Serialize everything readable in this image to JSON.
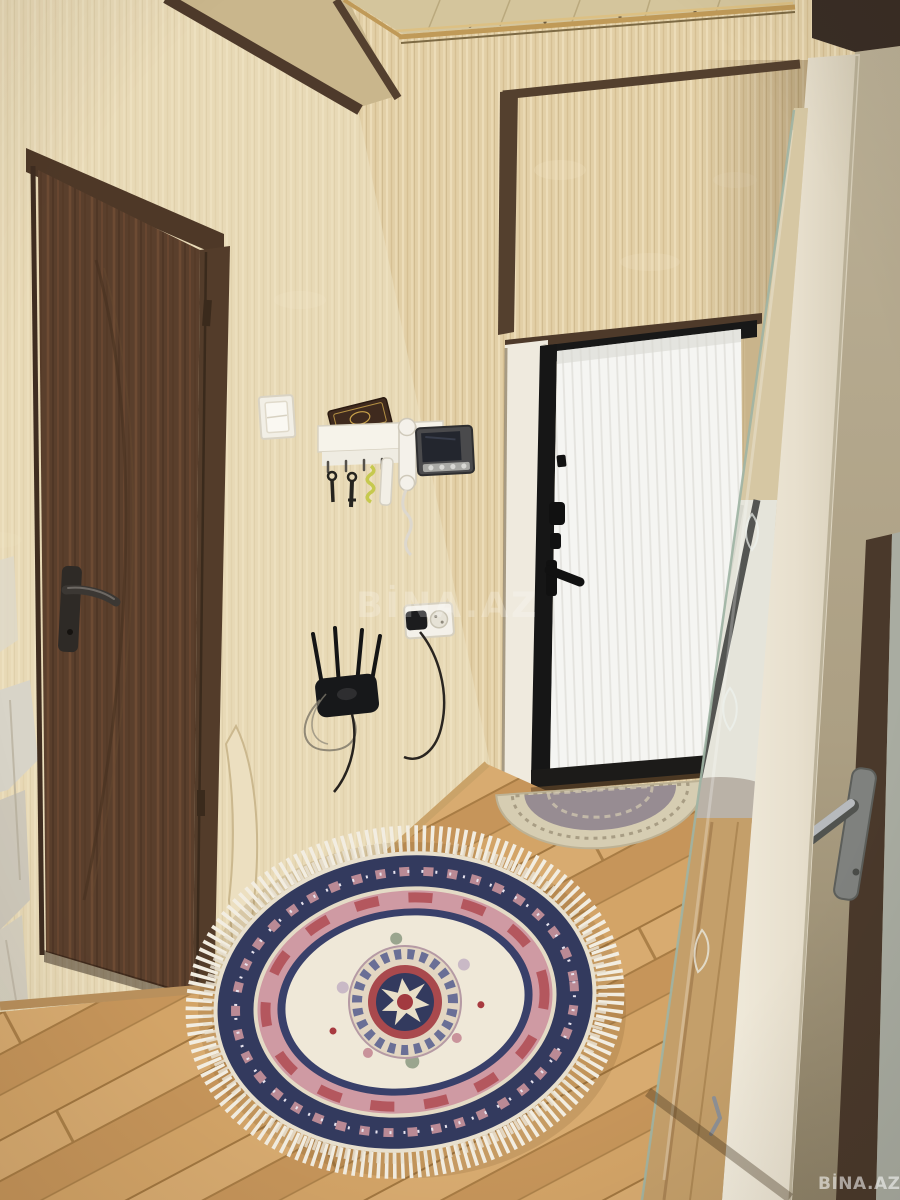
{
  "meta": {
    "kind": "real-estate interior photo",
    "width": 900,
    "height": 1200,
    "description": "Entrance hallway of an apartment: dark brown wooden door on the left, beige textured wallpaper, recessed entrance niche with a white ribbed security door in a black frame, cream wardrobe with a full-length etched mirror on the right, an open khaki door at the far right edge, light oak laminate floor laid diagonally, an oval oriental rug with white fringe in the foreground and a small semicircular doormat at the entrance door."
  },
  "watermarks": {
    "center": "BİNA.AZ",
    "corner": "BİNA.AZ"
  },
  "objects": {
    "left_door": "dark brown wooden interior door with dark lever handle and keyhole",
    "entrance_door": "white vertically-ribbed entrance door in a black steel frame with peephole, locks and black handle",
    "doormat": "semicircular beige and mauve doormat at the entrance door",
    "rug": "oval oriental rug: white fringe, navy floral border, rose ring, cream field with navy-red medallion",
    "wardrobe": "cream wardrobe with full-length mirror, etched leaf motifs",
    "right_door": "open khaki door with chrome lever handle, walnut edge band",
    "light_switch": "white light switch",
    "key_shelf": "white key shelf with hooks, hanging keys, coiled yellow keychain and rolled paper",
    "book": "small dark prayer book with gold oval emblem on the shelf",
    "intercom_handset": "white audio intercom handset with coiled cord",
    "video_intercom": "video intercom monitor, dark screen, silver button strip",
    "power_outlet": "white double power outlet with black plug and trailing cable",
    "wifi_router": "black four-antenna Wi-Fi router mounted on the wall with looped wires",
    "floor": "light oak laminate flooring laid diagonally",
    "ceiling": "beige panelled ceiling with brass trim and walnut soffit edges",
    "walls": "beige streaked wallpaper; damaged plaster patches at lower left; peeled wallpaper curl beside the door"
  },
  "palette": {
    "wallpaper": "#e2cfa6",
    "wallpaper_light": "#ecdcb8",
    "ceiling": "#d4c59c",
    "brass": "#c09a58",
    "walnut": "#503a2b",
    "left_door": "#5a3f2c",
    "white_door": "#f5f5f2",
    "frame_black": "#181818",
    "floor": "#cf9f63",
    "floor_seam": "#a87c44",
    "wardrobe": "#ece5d4",
    "mirror": "#dde3e2",
    "right_door": "#b4a88e",
    "rug_navy": "#333a5e",
    "rug_rose": "#cf9aa3",
    "rug_red": "#a23a40",
    "rug_cream": "#efe8d8",
    "fringe": "#f2ede1",
    "watermark": "#ffffff"
  }
}
